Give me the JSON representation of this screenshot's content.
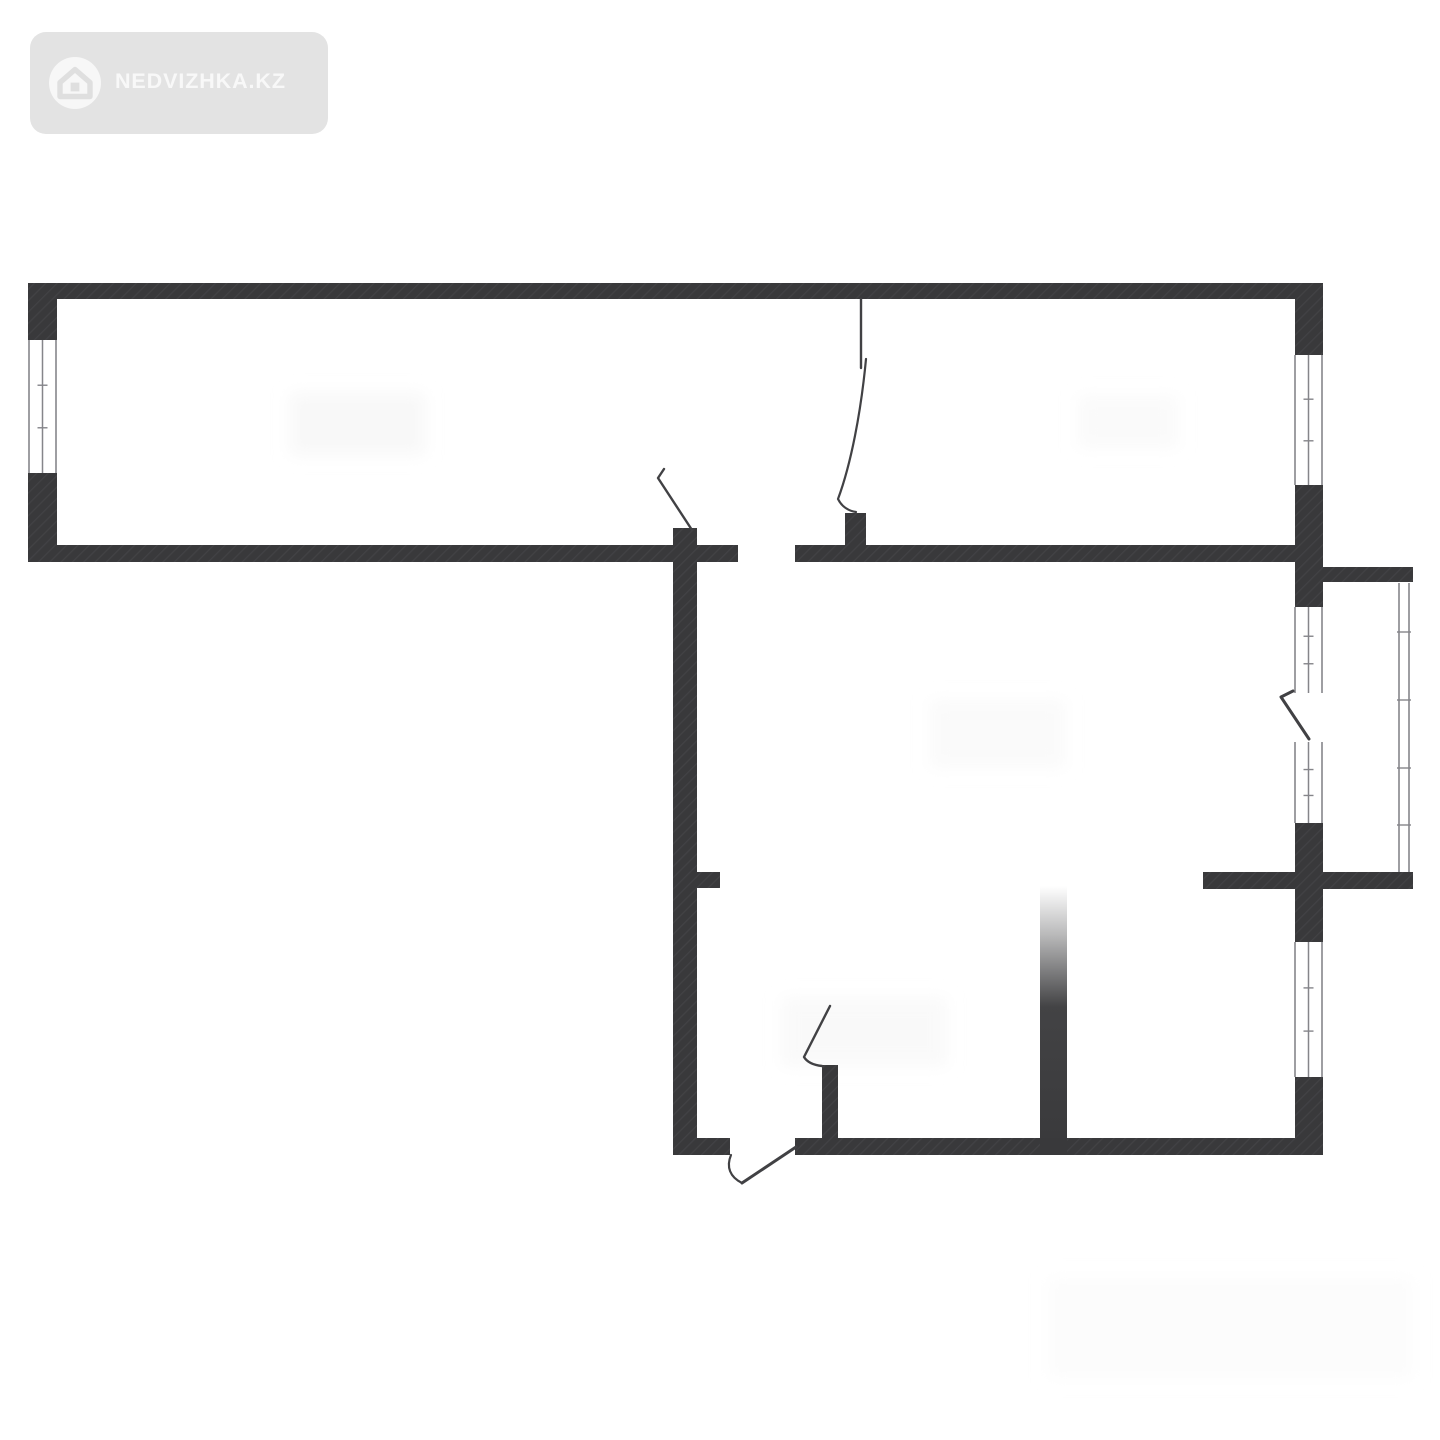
{
  "page": {
    "width": 1440,
    "height": 1440,
    "background": "#ffffff"
  },
  "logo": {
    "text": "NEDVIZHKA.KZ",
    "badge_color": "#e3e3e3",
    "text_color": "#f8f8f8",
    "icon_circle_color": "#f7f7f7",
    "icon_glyph_color": "#dfdfdf",
    "icon": "house-in-circle"
  },
  "floorplan": {
    "wall_color": "#39393b",
    "wall_hatch_color": "#424245",
    "door_line_color": "#414144",
    "window_line_color": "#85858a",
    "ghost_color": "#f8f8f8",
    "walls": [
      {
        "name": "top-exterior-wall",
        "x": 28,
        "y": 283,
        "w": 1295,
        "h": 16
      },
      {
        "name": "left-exterior-wall-upper",
        "x": 28,
        "y": 283,
        "w": 29,
        "h": 57
      },
      {
        "name": "left-exterior-wall-lower",
        "x": 28,
        "y": 473,
        "w": 29,
        "h": 89
      },
      {
        "name": "mid-wall-left-segment",
        "x": 28,
        "y": 545,
        "w": 710,
        "h": 17
      },
      {
        "name": "mid-wall-right-segment",
        "x": 795,
        "y": 545,
        "w": 500,
        "h": 17
      },
      {
        "name": "door-stub-top-right-room",
        "x": 845,
        "y": 513,
        "w": 21,
        "h": 32
      },
      {
        "name": "corridor-wall",
        "x": 673,
        "y": 528,
        "w": 24,
        "h": 627
      },
      {
        "name": "right-exterior-wall-seg1",
        "x": 1295,
        "y": 283,
        "w": 28,
        "h": 72
      },
      {
        "name": "right-exterior-wall-seg2",
        "x": 1295,
        "y": 485,
        "w": 28,
        "h": 122
      },
      {
        "name": "right-exterior-wall-seg3",
        "x": 1295,
        "y": 823,
        "w": 28,
        "h": 119
      },
      {
        "name": "right-exterior-wall-seg4",
        "x": 1295,
        "y": 1077,
        "w": 28,
        "h": 78
      },
      {
        "name": "bottom-wall-left-segment",
        "x": 673,
        "y": 1138,
        "w": 57,
        "h": 17
      },
      {
        "name": "bottom-wall-right-segment",
        "x": 795,
        "y": 1138,
        "w": 528,
        "h": 17
      },
      {
        "name": "hall-stub-left",
        "x": 695,
        "y": 872,
        "w": 25,
        "h": 16
      },
      {
        "name": "hall-stub-and-balcony-floor",
        "x": 1203,
        "y": 872,
        "w": 210,
        "h": 17
      },
      {
        "name": "balcony-top-wall",
        "x": 1323,
        "y": 567,
        "w": 90,
        "h": 15
      },
      {
        "name": "bottom-room-stub",
        "x": 822,
        "y": 1065,
        "w": 16,
        "h": 80
      }
    ],
    "fade_wall": {
      "name": "faded-partition-wall",
      "x": 1040,
      "y": 886,
      "w": 27,
      "h": 269
    },
    "windows": [
      {
        "name": "window-left-room",
        "x": 28,
        "y": 340,
        "w": 29,
        "h": 133
      },
      {
        "name": "window-top-right-room",
        "x": 1294,
        "y": 355,
        "w": 29,
        "h": 130
      },
      {
        "name": "balcony-glazing-upper",
        "x": 1294,
        "y": 607,
        "w": 29,
        "h": 86
      },
      {
        "name": "balcony-glazing-lower",
        "x": 1294,
        "y": 742,
        "w": 29,
        "h": 81
      },
      {
        "name": "window-bottom-right-room",
        "x": 1294,
        "y": 942,
        "w": 29,
        "h": 135
      }
    ],
    "railing": {
      "name": "balcony-railing",
      "x1": 1399,
      "x2": 1409,
      "y1": 583,
      "y2": 872,
      "ticks_y": [
        632,
        700,
        768,
        825
      ]
    },
    "doors": [
      {
        "name": "door-leaf-top-right-room",
        "path": "M861 299 L861 368",
        "width": 2.4
      },
      {
        "name": "door-swing-top-right-room",
        "path": "M866 359 C861 412 851 464 838 499 C842 507 849 511 856 512",
        "width": 2.2
      },
      {
        "name": "door-leaf-left-room",
        "path": "M664 469 L658 478 L692 530",
        "width": 2.4
      },
      {
        "name": "door-leaf-balcony",
        "path": "M1293 691 L1281 697 L1309 739",
        "width": 3
      },
      {
        "name": "door-leaf-bottom-room",
        "path": "M830 1006 L804 1057 C807 1062 813 1065 822 1066",
        "width": 2.4
      },
      {
        "name": "entrance-door-swing",
        "path": "M731 1155 C726 1167 730 1177 742 1183",
        "width": 2.2
      },
      {
        "name": "entrance-door-leaf",
        "path": "M742 1183 L796 1147",
        "width": 3
      }
    ],
    "ghost_marks": [
      {
        "x": 290,
        "y": 393,
        "w": 135,
        "h": 62,
        "fill": "#f8f8f8"
      },
      {
        "x": 1078,
        "y": 396,
        "w": 100,
        "h": 52,
        "fill": "#fafafa"
      },
      {
        "x": 930,
        "y": 700,
        "w": 135,
        "h": 68,
        "fill": "#fafafa"
      },
      {
        "x": 782,
        "y": 998,
        "w": 165,
        "h": 68,
        "fill": "#f9f9f9"
      },
      {
        "x": 1048,
        "y": 1278,
        "w": 365,
        "h": 100,
        "fill": "#fcfcfc"
      }
    ]
  }
}
